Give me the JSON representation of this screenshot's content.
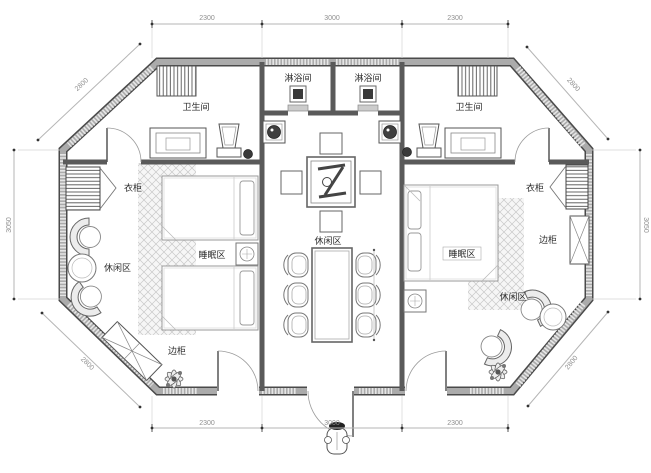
{
  "plan": {
    "type": "architectural-floor-plan",
    "shape": "octagon",
    "labels": {
      "bathroom": "卫生间",
      "shower_room": "淋浴间",
      "wardrobe": "衣柜",
      "sleeping_area": "睡眠区",
      "leisure_area": "休闲区",
      "side_cabinet": "边柜"
    },
    "dimensions": {
      "top": [
        "2300",
        "3000",
        "2300"
      ],
      "bottom": [
        "2300",
        "3000",
        "2300"
      ],
      "left_side": "3050",
      "right_side": "3050",
      "diagonals": [
        "2800",
        "2800",
        "2800",
        "2800"
      ]
    },
    "colors": {
      "background": "#ffffff",
      "wall_fill": "#ababab",
      "wall_edge": "#4a4a4a",
      "interior_wall": "#5a5a5a",
      "furniture_line": "#666666",
      "dim_line": "#b5b5b5",
      "hatch": "#c9c9c9"
    }
  }
}
